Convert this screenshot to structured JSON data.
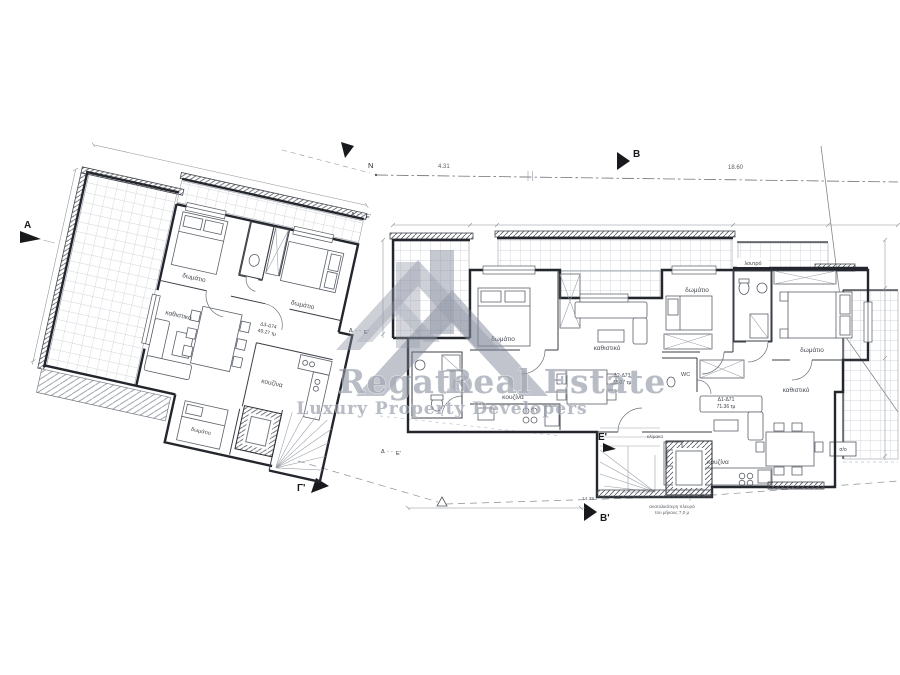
{
  "watermark": {
    "brand_first": "Regato",
    "brand_rest": "Real Estate",
    "brand_full": "Regato Real Estate",
    "tagline": "Luxury Property Developers",
    "logo": "house-roofs-icon",
    "color": "#8d93a2"
  },
  "labels": {
    "bedroom": "δωμάτιο",
    "living": "καθιστικό",
    "kitchen": "κουζίνα",
    "bath": "λουτρό",
    "wc": "WC",
    "stairs": "κλίμακα",
    "storage": "σ/ο"
  },
  "apartments": {
    "left": {
      "code": "Δ3-Δ74",
      "area": "49.27 τμ"
    },
    "middle": {
      "code": "Δ2-Δ73",
      "area": "48.07 τμ"
    },
    "right": {
      "code": "Δ1-Δ71",
      "area": "71.36 τμ"
    }
  },
  "markers": {
    "a": "A",
    "b": "B",
    "b_prime": "B'",
    "gamma": "Γ'",
    "e_prime": "E'",
    "north": "N",
    "sec_d": "Δ",
    "sec_e": "Ε'"
  },
  "dimensions": {
    "top_left": "4.31",
    "top_right": "18.60",
    "bottom": "14.39"
  },
  "notes": {
    "line1": "ανατολικότερη πλευρά",
    "line2": "του μήκους 7,0 μ"
  }
}
